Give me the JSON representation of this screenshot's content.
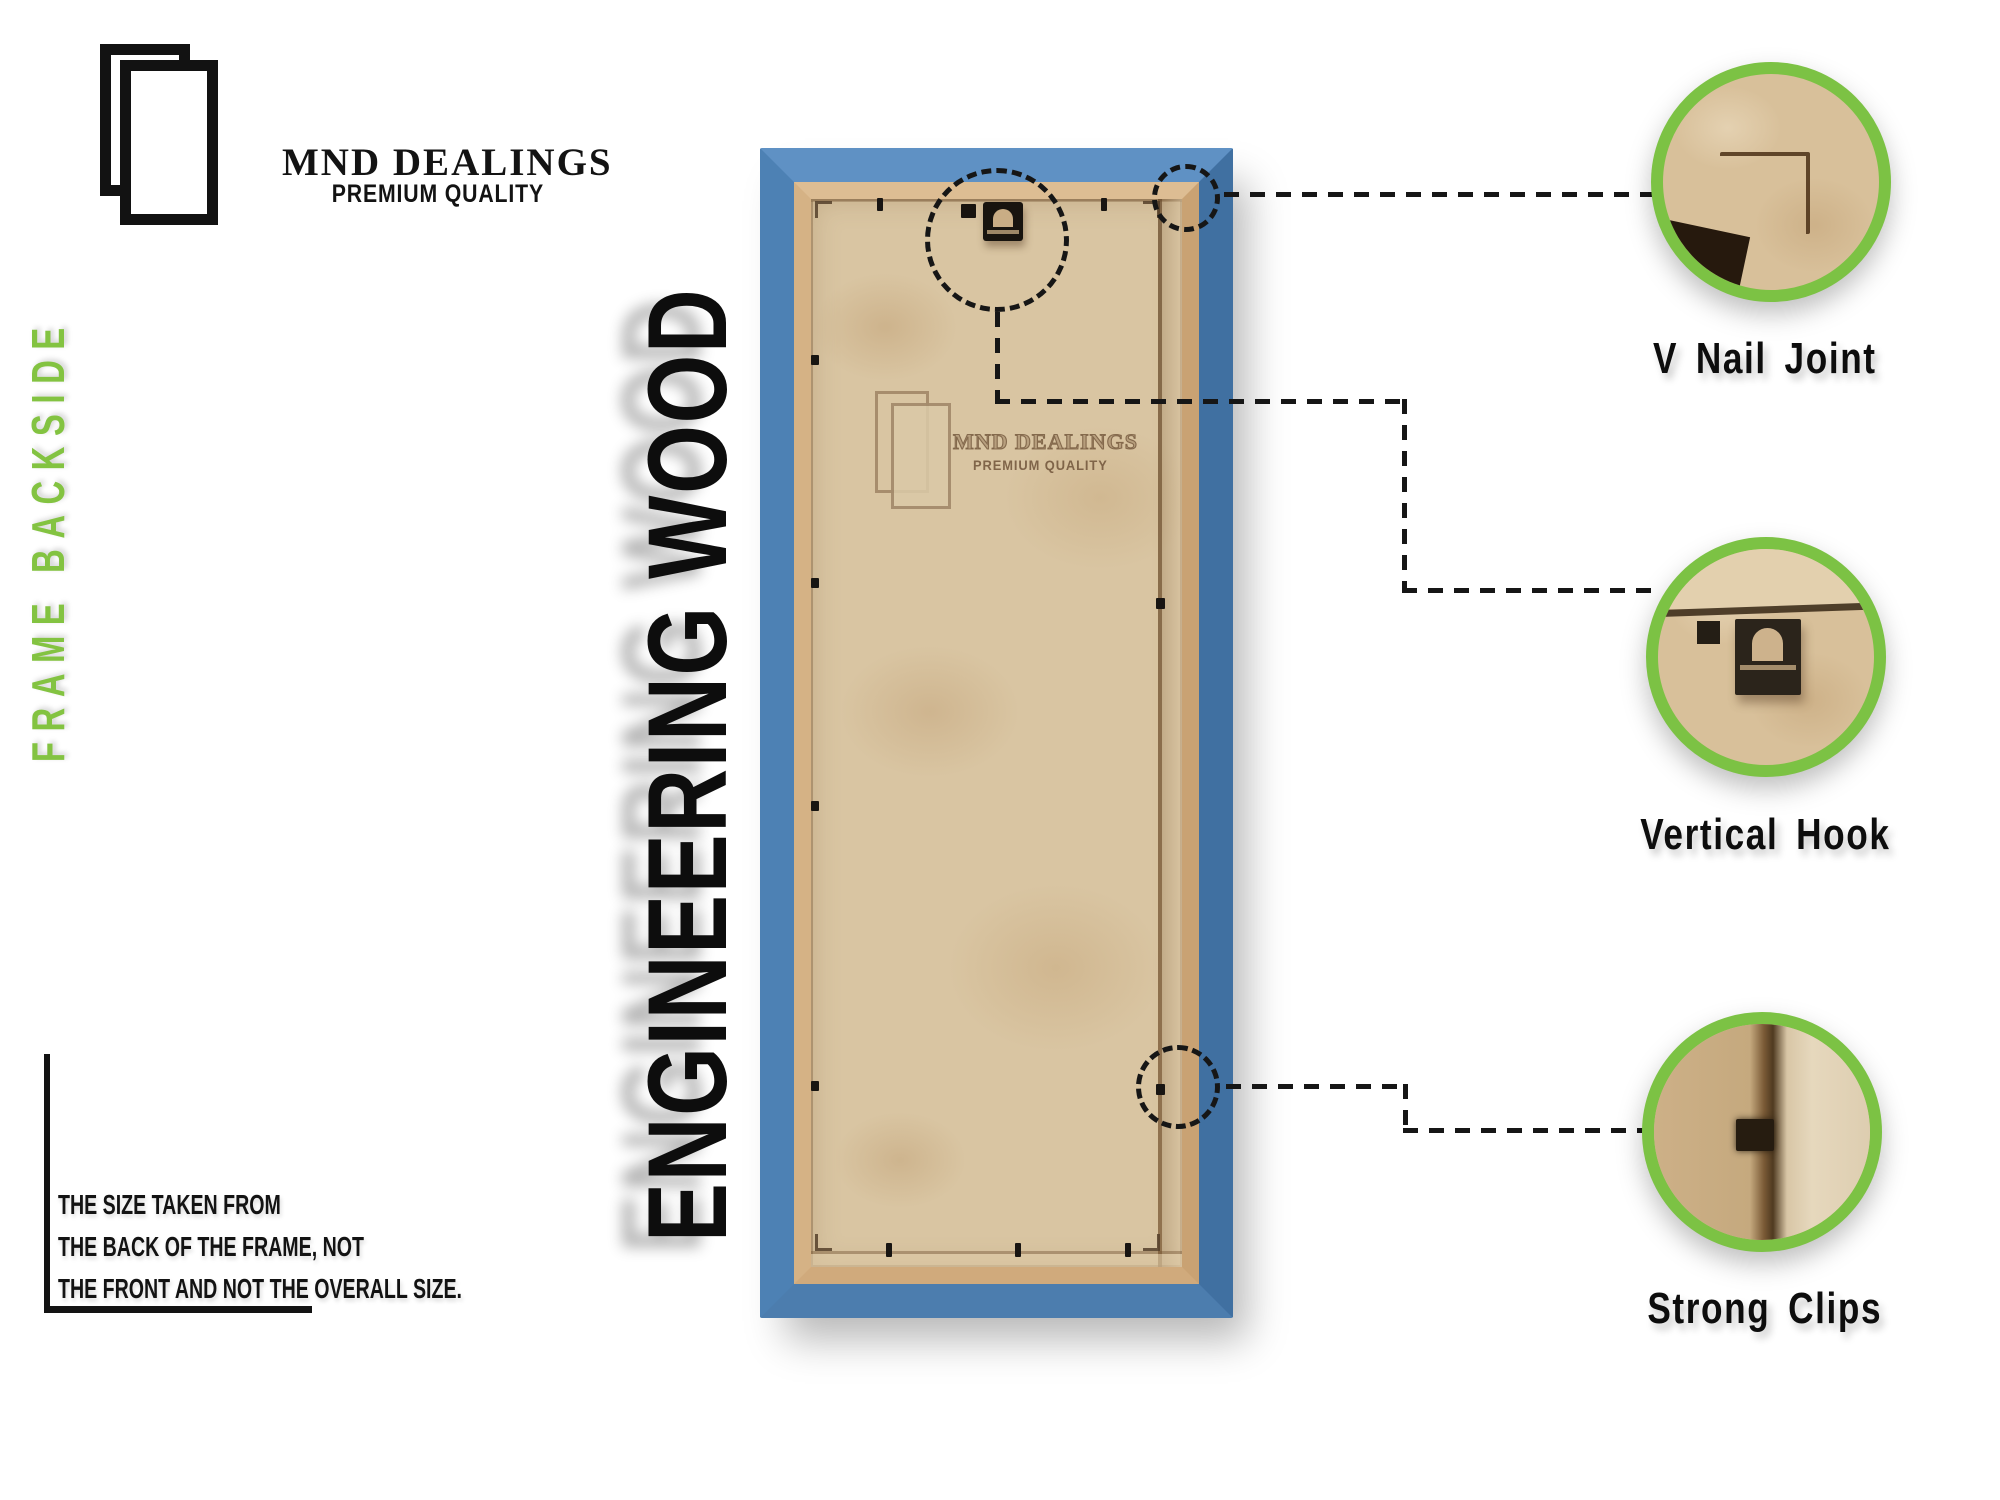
{
  "brand": {
    "name": "MND DEALINGS",
    "tagline": "PREMIUM QUALITY"
  },
  "side_label": "FRAME BACKSIDE",
  "product_title": "ENGINEERING WOOD",
  "note": {
    "lines": [
      "THE SIZE TAKEN FROM",
      "THE BACK OF THE FRAME, NOT",
      "THE FRONT AND NOT THE OVERALL SIZE."
    ]
  },
  "watermark": {
    "name": "MND DEALINGS",
    "tagline": "PREMIUM QUALITY"
  },
  "callouts": [
    {
      "id": "v-nail-joint",
      "label": "V Nail Joint"
    },
    {
      "id": "vertical-hook",
      "label": "Vertical Hook"
    },
    {
      "id": "strong-clips",
      "label": "Strong Clips"
    }
  ],
  "colors": {
    "accent_green": "#7CC244",
    "side_label_green": "#83C341",
    "frame_blue": "#4D81B4",
    "moulding_tan": "#D5B285",
    "backing_tan": "#D9C5A2",
    "ink": "#131313"
  }
}
